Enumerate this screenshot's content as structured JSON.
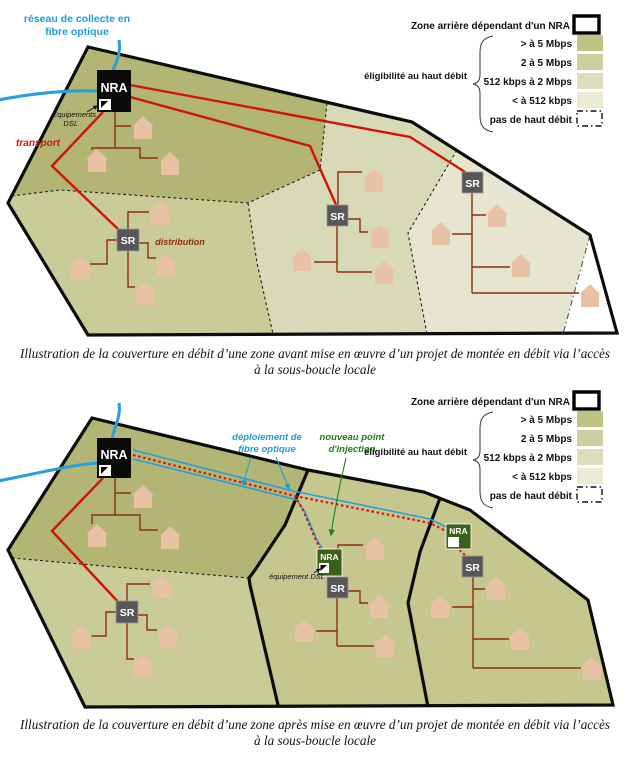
{
  "legend": {
    "zone_label": "Zone arrière dépendant d'un NRA",
    "eligibility_label": "éligibilité au haut débit",
    "tiers": [
      {
        "label": "> à 5 Mbps",
        "color": "#c1c384"
      },
      {
        "label": "2 à 5 Mbps",
        "color": "#cdcf9e"
      },
      {
        "label": "512 kbps à 2 Mbps",
        "color": "#dcddbb"
      },
      {
        "label": "< à 512 kbps",
        "color": "#eaead5"
      }
    ],
    "no_broadband_label": "pas de haut débit"
  },
  "diagram1": {
    "nra_label": "NRA",
    "sr_label": "SR",
    "fiber_collect_line1": "réseau de collecte en",
    "fiber_collect_line2": "fibre optique",
    "dsl_equipment_line1": "Equipements",
    "dsl_equipment_line2": "DSL",
    "transport_label": "transport",
    "distribution_label": "distribution",
    "caption_line1": "Illustration de la couverture en débit d’une zone avant mise en œuvre d’un projet de montée en débit via l’accès",
    "caption_line2": "à la sous-boucle locale"
  },
  "diagram2": {
    "nra_label": "NRA",
    "sr_label": "SR",
    "fiber_deploy_line1": "déploiement de",
    "fiber_deploy_line2": "fibre optique",
    "new_injection_line1": "nouveau point",
    "new_injection_line2": "d'injection",
    "dsl_equipment_label": "équipement DSL",
    "caption_line1": "Illustration de la couverture en débit d’une zone après mise en œuvre d’un projet de montée en débit via l’accès",
    "caption_line2": "à la sous-boucle locale"
  },
  "colors": {
    "zone_darkest": "#b2b573",
    "zone_medium": "#c9cb98",
    "zone_light": "#d8d9b6",
    "zone_lightest": "#e6e6d0",
    "zone_mid2": "#c5c78e",
    "transport_red": "#d01408",
    "distribution_brown": "#8f2e0e",
    "fiber_dotted_red": "#e01010",
    "fiber_blue": "#2a9fd8",
    "injection_green": "#1e7e1c",
    "nra_black_box": "#0a0a0a",
    "nra_green_box": "#3a611a",
    "sr_gray_box": "#57575a",
    "house": "#e9c2a6"
  }
}
